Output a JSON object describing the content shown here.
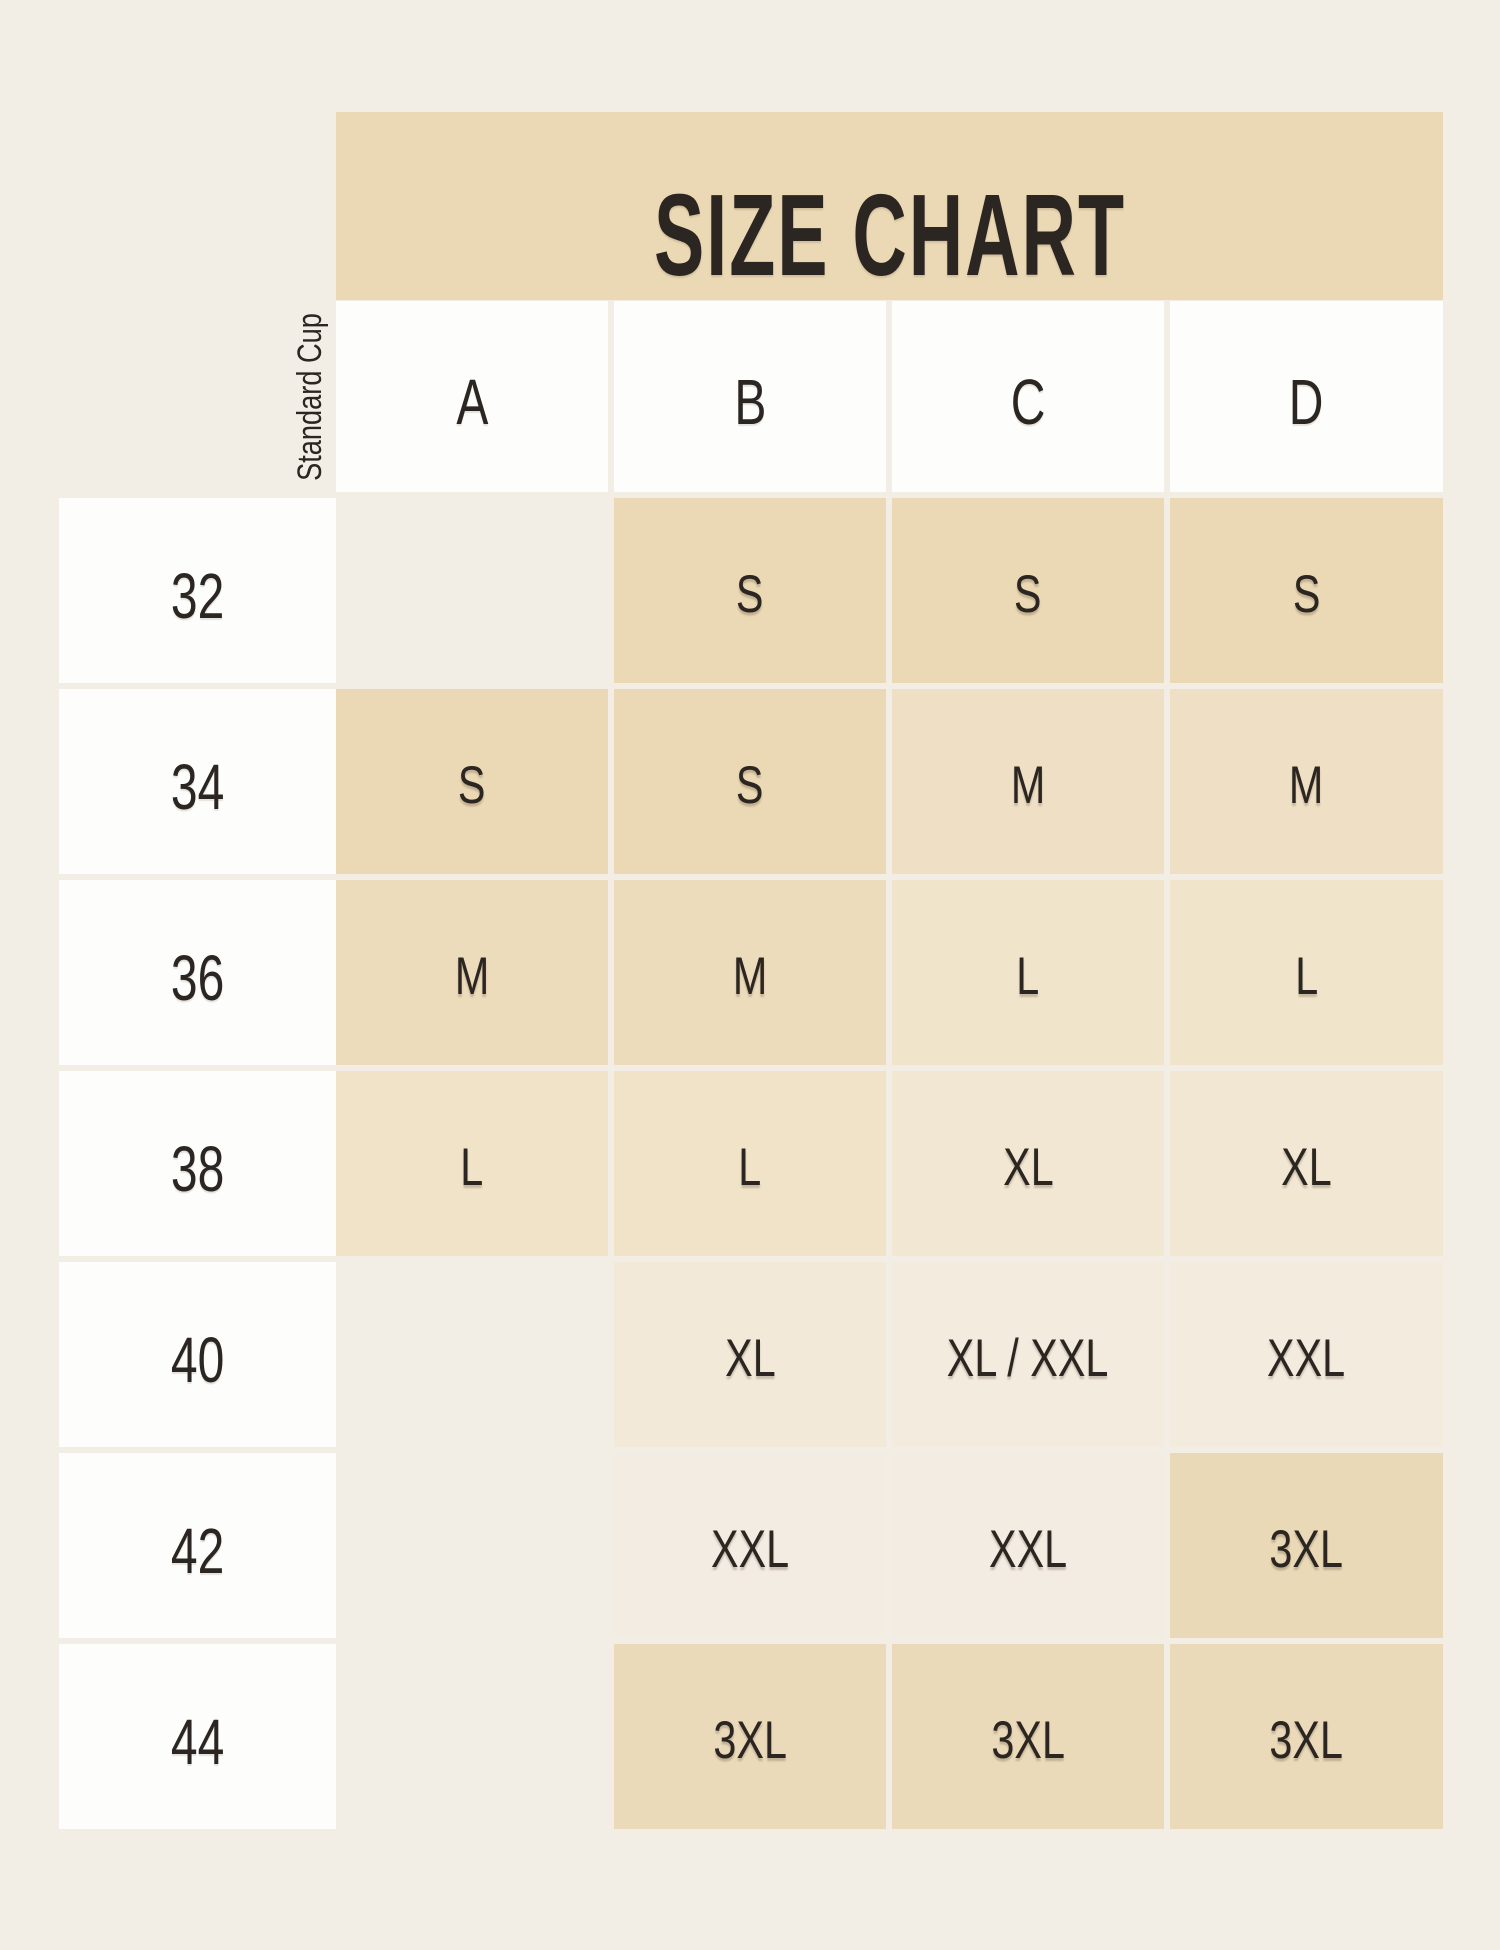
{
  "page": {
    "background_color": "#f2ede5",
    "text_color": "#2b2621",
    "white_cell_color": "#fdfdfc"
  },
  "title": {
    "label": "SIZE CHART",
    "band_color": "#ebd8b4"
  },
  "header": {
    "corner_label": "Standard Cup",
    "columns": [
      "A",
      "B",
      "C",
      "D"
    ]
  },
  "rows": [
    {
      "band": "32",
      "cells": [
        {
          "v": "",
          "bg": ""
        },
        {
          "v": "S",
          "bg": "#ebd8b4"
        },
        {
          "v": "S",
          "bg": "#ebd8b4"
        },
        {
          "v": "S",
          "bg": "#ebd8b4"
        }
      ]
    },
    {
      "band": "34",
      "cells": [
        {
          "v": "S",
          "bg": "#ebd8b4"
        },
        {
          "v": "S",
          "bg": "#ebd8b4"
        },
        {
          "v": "M",
          "bg": "#efe0c5"
        },
        {
          "v": "M",
          "bg": "#efe0c5"
        }
      ]
    },
    {
      "band": "36",
      "cells": [
        {
          "v": "M",
          "bg": "#eddcbc"
        },
        {
          "v": "M",
          "bg": "#eddcbc"
        },
        {
          "v": "L",
          "bg": "#f0e4cb"
        },
        {
          "v": "L",
          "bg": "#f0e4cb"
        }
      ]
    },
    {
      "band": "38",
      "cells": [
        {
          "v": "L",
          "bg": "#f0e3c8"
        },
        {
          "v": "L",
          "bg": "#f0e3c8"
        },
        {
          "v": "XL",
          "bg": "#f2e7d3"
        },
        {
          "v": "XL",
          "bg": "#f2e7d3"
        }
      ]
    },
    {
      "band": "40",
      "cells": [
        {
          "v": "",
          "bg": ""
        },
        {
          "v": "XL",
          "bg": "#f3e9d8"
        },
        {
          "v": "XL / XXL",
          "bg": "#f3ebde"
        },
        {
          "v": "XXL",
          "bg": "#f3ebde"
        }
      ]
    },
    {
      "band": "42",
      "cells": [
        {
          "v": "",
          "bg": ""
        },
        {
          "v": "XXL",
          "bg": "#f3ece2"
        },
        {
          "v": "XXL",
          "bg": "#f3ece2"
        },
        {
          "v": "3XL",
          "bg": "#ead9b7"
        }
      ]
    },
    {
      "band": "44",
      "cells": [
        {
          "v": "",
          "bg": ""
        },
        {
          "v": "3XL",
          "bg": "#ebdaba"
        },
        {
          "v": "3XL",
          "bg": "#ebdaba"
        },
        {
          "v": "3XL",
          "bg": "#ebdaba"
        }
      ]
    }
  ],
  "chart_data": {
    "type": "table",
    "title": "SIZE CHART",
    "corner_label": "Standard Cup",
    "columns": [
      "A",
      "B",
      "C",
      "D"
    ],
    "row_labels": [
      "32",
      "34",
      "36",
      "38",
      "40",
      "42",
      "44"
    ],
    "values": [
      [
        "",
        "S",
        "S",
        "S"
      ],
      [
        "S",
        "S",
        "M",
        "M"
      ],
      [
        "M",
        "M",
        "L",
        "L"
      ],
      [
        "L",
        "L",
        "XL",
        "XL"
      ],
      [
        "",
        "XL",
        "XL / XXL",
        "XXL"
      ],
      [
        "",
        "XXL",
        "XXL",
        "3XL"
      ],
      [
        "",
        "3XL",
        "3XL",
        "3XL"
      ]
    ]
  }
}
